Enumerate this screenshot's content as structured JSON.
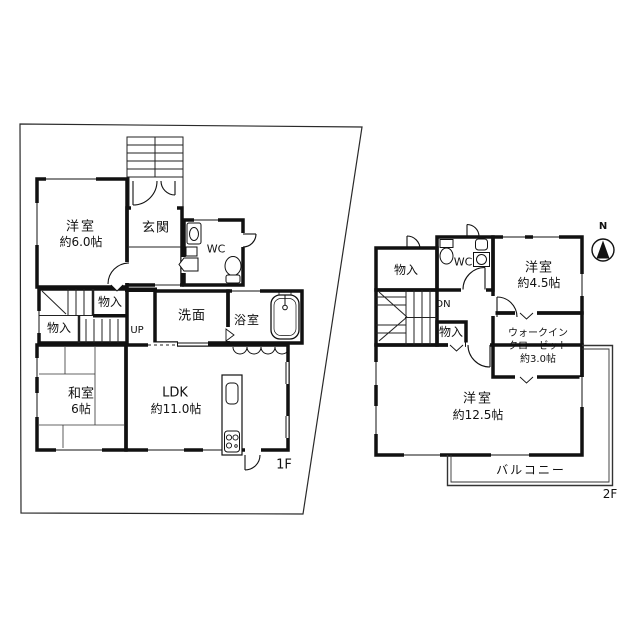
{
  "colors": {
    "wall": "#111111",
    "thin_line": "#333333",
    "background": "#ffffff"
  },
  "floor1": {
    "floor_label": "1F",
    "rooms": {
      "yoshitsu6": {
        "name": "洋室",
        "size": "約6.0帖"
      },
      "genkan": {
        "name": "玄関"
      },
      "wc": {
        "name": "WC"
      },
      "monoire_upper": {
        "name": "物入"
      },
      "monoire_lower": {
        "name": "物入"
      },
      "stairs_up": {
        "name": "UP"
      },
      "senmen": {
        "name": "洗面"
      },
      "bathroom": {
        "name": "浴室"
      },
      "washitsu": {
        "name": "和室",
        "size": "6帖"
      },
      "ldk": {
        "name": "LDK",
        "size": "約11.0帖"
      }
    }
  },
  "floor2": {
    "floor_label": "2F",
    "compass_label": "N",
    "rooms": {
      "monoire_top": {
        "name": "物入"
      },
      "wc": {
        "name": "WC"
      },
      "yoshitsu45": {
        "name": "洋室",
        "size": "約4.5帖"
      },
      "stairs_down": {
        "name": "DN"
      },
      "monoire_mid": {
        "name": "物入"
      },
      "wic": {
        "line1": "ウォークイン",
        "line2": "クローゼット",
        "size": "約3.0帖"
      },
      "yoshitsu125": {
        "name": "洋室",
        "size": "約12.5帖"
      },
      "balcony": {
        "name": "バルコニー"
      }
    }
  }
}
